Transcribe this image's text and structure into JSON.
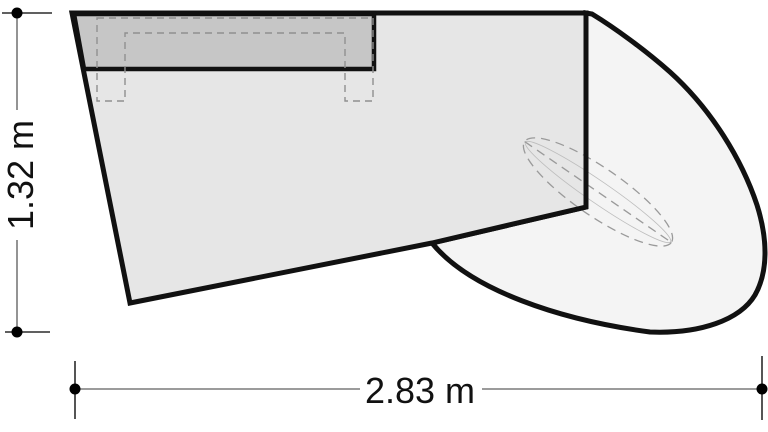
{
  "diagram": {
    "vertical_dimension_label": "1.32 m",
    "horizontal_dimension_label": "2.83 m",
    "colors": {
      "outline": "#111111",
      "room_fill": "#e6e6e6",
      "band_fill": "#c6c6c6",
      "swing_region_fill": "#f4f4f4",
      "hidden_dashed": "#9a9a9a",
      "dimension_line": "#7a7a7a",
      "dimension_tick": "#2b2b2b",
      "dimension_marker": "#000000",
      "background": "#ffffff"
    }
  }
}
